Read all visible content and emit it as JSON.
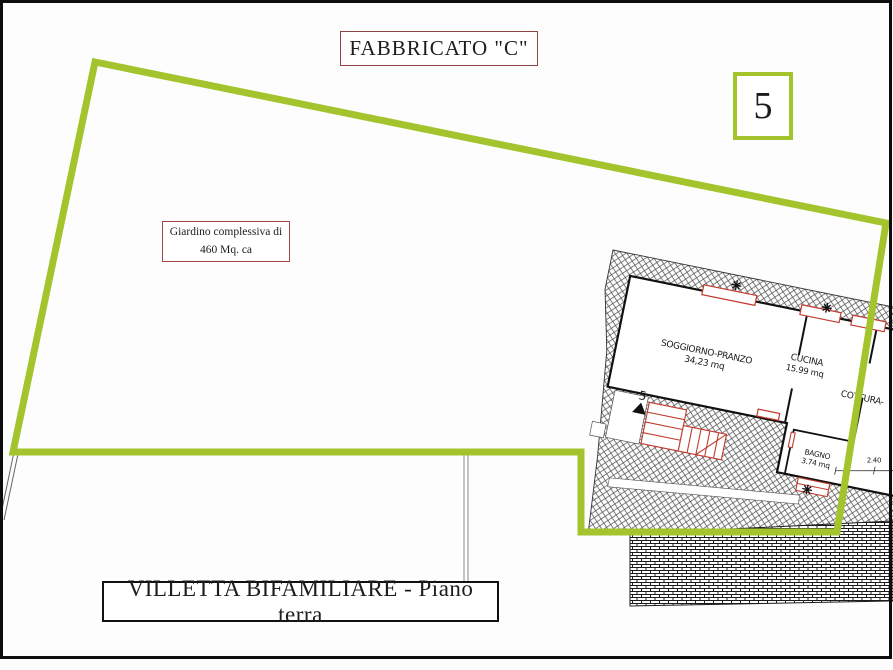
{
  "page": {
    "title_top": "FABBRICATO \"C\"",
    "badge_number": "5",
    "garden_label_line1": "Giardino complessiva di",
    "garden_label_line2": "460 Mq. ca",
    "title_bottom": "VILLETTA BIFAMILIARE - Piano terra"
  },
  "plan": {
    "rooms": [
      {
        "name": "SOGGIORNO-PRANZO",
        "area": "34,23 mq"
      },
      {
        "name": "CUCINA",
        "area": "15.99 mq"
      },
      {
        "name": "BAGNO",
        "area": "3.74 mq"
      },
      {
        "name": "COTTURA-",
        "area": ""
      }
    ],
    "entrance_number": "5",
    "dimension": "2.40"
  },
  "colors": {
    "boundary_green": "#a3c42c",
    "title_box_red": "#8f4444",
    "plan_red": "#c23b2e"
  }
}
